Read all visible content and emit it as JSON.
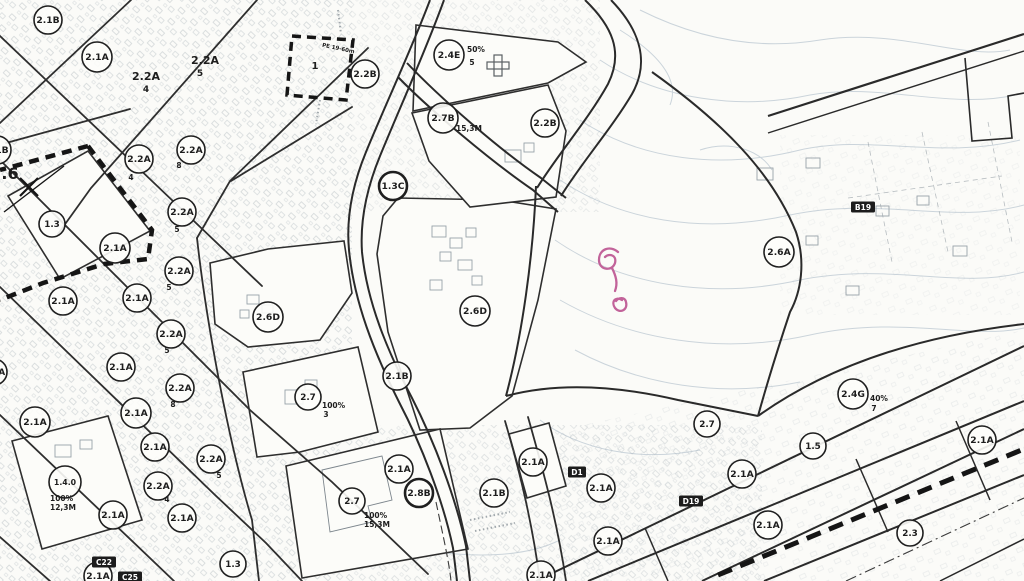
{
  "map": {
    "title": "zoning-plan-scan",
    "colors": {
      "background": "#fbfbf8",
      "ink": "#262626",
      "road": "#2e2e2e",
      "faint_buildings": "#a2abb2",
      "contours": "#c3ced6",
      "badge_bg": "#1c1c1c",
      "annotation_pink": "#c2639a"
    }
  },
  "zone_circles": [
    {
      "x": 48,
      "y": 20,
      "r": 14,
      "label": "2.1B"
    },
    {
      "x": 97,
      "y": 57,
      "r": 15,
      "label": "2.1A"
    },
    {
      "x": 139,
      "y": 159,
      "r": 14,
      "label": "2.2A",
      "subs": [
        {
          "t": "4",
          "x": 131,
          "y": 180
        }
      ]
    },
    {
      "x": 191,
      "y": 150,
      "r": 14,
      "label": "2.2A",
      "subs": [
        {
          "t": "8",
          "x": 179,
          "y": 168
        }
      ]
    },
    {
      "x": 182,
      "y": 212,
      "r": 14,
      "label": "2.2A",
      "subs": [
        {
          "t": "5",
          "x": 177,
          "y": 232
        }
      ]
    },
    {
      "x": 52,
      "y": 224,
      "r": 13,
      "label": "1.3"
    },
    {
      "x": 115,
      "y": 248,
      "r": 15,
      "label": "2.1A"
    },
    {
      "x": 179,
      "y": 271,
      "r": 14,
      "label": "2.2A",
      "subs": [
        {
          "t": "5",
          "x": 169,
          "y": 290
        }
      ]
    },
    {
      "x": 63,
      "y": 301,
      "r": 14,
      "label": "2.1A"
    },
    {
      "x": 137,
      "y": 298,
      "r": 14,
      "label": "2.1A"
    },
    {
      "x": 171,
      "y": 334,
      "r": 14,
      "label": "2.2A",
      "subs": [
        {
          "t": "5",
          "x": 167,
          "y": 353
        }
      ]
    },
    {
      "x": 121,
      "y": 367,
      "r": 14,
      "label": "2.1A"
    },
    {
      "x": 180,
      "y": 388,
      "r": 14,
      "label": "2.2A",
      "subs": [
        {
          "t": "8",
          "x": 173,
          "y": 407
        }
      ]
    },
    {
      "x": 35,
      "y": 422,
      "r": 15,
      "label": "2.1A"
    },
    {
      "x": 136,
      "y": 413,
      "r": 15,
      "label": "2.1A"
    },
    {
      "x": 155,
      "y": 447,
      "r": 14,
      "label": "2.1A"
    },
    {
      "x": 211,
      "y": 459,
      "r": 14,
      "label": "2.2A",
      "subs": [
        {
          "t": "5",
          "x": 219,
          "y": 478
        }
      ]
    },
    {
      "x": 65,
      "y": 482,
      "r": 16,
      "label": "1.4.0",
      "subs": [
        {
          "t": "100%",
          "x": 50,
          "y": 501,
          "a": "s"
        },
        {
          "t": "12,3M",
          "x": 50,
          "y": 510,
          "a": "s"
        }
      ]
    },
    {
      "x": 158,
      "y": 486,
      "r": 14,
      "label": "2.2A",
      "subs": [
        {
          "t": "4",
          "x": 167,
          "y": 502
        }
      ]
    },
    {
      "x": 113,
      "y": 515,
      "r": 14,
      "label": "2.1A"
    },
    {
      "x": 182,
      "y": 518,
      "r": 14,
      "label": "2.1A"
    },
    {
      "x": 233,
      "y": 564,
      "r": 13,
      "label": "1.3"
    },
    {
      "x": 98,
      "y": 576,
      "r": 14,
      "label": "2.1A"
    },
    {
      "x": -3,
      "y": 150,
      "r": 14,
      "label": "2.1B"
    },
    {
      "x": -6,
      "y": 372,
      "r": 13,
      "label": "2.1A"
    },
    {
      "x": 308,
      "y": 397,
      "r": 13,
      "label": "2.7",
      "subs": [
        {
          "t": "100%",
          "x": 322,
          "y": 408,
          "a": "s"
        },
        {
          "t": "3",
          "x": 326,
          "y": 417
        }
      ]
    },
    {
      "x": 352,
      "y": 501,
      "r": 13,
      "label": "2.7",
      "subs": [
        {
          "t": "100%",
          "x": 364,
          "y": 518,
          "a": "s"
        },
        {
          "t": "15,3M",
          "x": 364,
          "y": 527,
          "a": "s"
        }
      ]
    },
    {
      "x": 268,
      "y": 317,
      "r": 15,
      "label": "2.6D"
    },
    {
      "x": 475,
      "y": 311,
      "r": 15,
      "label": "2.6D"
    },
    {
      "x": 397,
      "y": 376,
      "r": 14,
      "label": "2.1B"
    },
    {
      "x": 399,
      "y": 469,
      "r": 14,
      "label": "2.1A"
    },
    {
      "x": 419,
      "y": 493,
      "r": 14,
      "label": "2.8B",
      "bold": true
    },
    {
      "x": 494,
      "y": 493,
      "r": 14,
      "label": "2.1B"
    },
    {
      "x": 533,
      "y": 462,
      "r": 14,
      "label": "2.1A"
    },
    {
      "x": 601,
      "y": 488,
      "r": 14,
      "label": "2.1A"
    },
    {
      "x": 608,
      "y": 541,
      "r": 14,
      "label": "2.1A"
    },
    {
      "x": 541,
      "y": 575,
      "r": 14,
      "label": "2.1A"
    },
    {
      "x": 707,
      "y": 424,
      "r": 13,
      "label": "2.7"
    },
    {
      "x": 742,
      "y": 474,
      "r": 14,
      "label": "2.1A"
    },
    {
      "x": 768,
      "y": 525,
      "r": 14,
      "label": "2.1A"
    },
    {
      "x": 853,
      "y": 394,
      "r": 15,
      "label": "2.4G",
      "subs": [
        {
          "t": "40%",
          "x": 870,
          "y": 401,
          "a": "s"
        },
        {
          "t": "7",
          "x": 874,
          "y": 411
        }
      ]
    },
    {
      "x": 813,
      "y": 446,
      "r": 13,
      "label": "1.5"
    },
    {
      "x": 982,
      "y": 440,
      "r": 14,
      "label": "2.1A"
    },
    {
      "x": 910,
      "y": 533,
      "r": 13,
      "label": "2.3"
    },
    {
      "x": 365,
      "y": 74,
      "r": 14,
      "label": "2.2B"
    },
    {
      "x": 449,
      "y": 55,
      "r": 15,
      "label": "2.4E",
      "subs": [
        {
          "t": "50%",
          "x": 467,
          "y": 52,
          "a": "s"
        },
        {
          "t": "5",
          "x": 472,
          "y": 65
        }
      ]
    },
    {
      "x": 443,
      "y": 118,
      "r": 15,
      "label": "2.7B",
      "subs": [
        {
          "t": "15,3M",
          "x": 456,
          "y": 131,
          "a": "s"
        }
      ]
    },
    {
      "x": 545,
      "y": 123,
      "r": 14,
      "label": "2.2B"
    },
    {
      "x": 393,
      "y": 186,
      "r": 14,
      "label": "1.3C",
      "bold": true
    },
    {
      "x": 779,
      "y": 252,
      "r": 15,
      "label": "2.6A"
    }
  ],
  "plain_labels": [
    {
      "x": 146,
      "y": 80,
      "t": "2.2A",
      "size": 11
    },
    {
      "x": 146,
      "y": 92,
      "t": "4",
      "size": 9
    },
    {
      "x": 205,
      "y": 64,
      "t": "2.2A",
      "size": 11
    },
    {
      "x": 200,
      "y": 76,
      "t": "5",
      "size": 9
    },
    {
      "x": 10,
      "y": 179,
      "t": ".6",
      "size": 16
    },
    {
      "x": 315,
      "y": 69,
      "t": "1",
      "size": 10
    },
    {
      "x": 338,
      "y": 50,
      "t": "PE 19-60m",
      "size": 5.5,
      "rot": 12,
      "color": "#7b838a"
    }
  ],
  "badges": [
    {
      "x": 863,
      "y": 207,
      "t": "B19"
    },
    {
      "x": 577,
      "y": 472,
      "t": "D1"
    },
    {
      "x": 691,
      "y": 501,
      "t": "D19"
    },
    {
      "x": 104,
      "y": 562,
      "t": "C22"
    },
    {
      "x": 130,
      "y": 577,
      "t": "C25"
    }
  ],
  "annotations": {
    "pink_squiggle": "handwritten question-mark pencil mark",
    "pink_color": "#c2639a"
  }
}
